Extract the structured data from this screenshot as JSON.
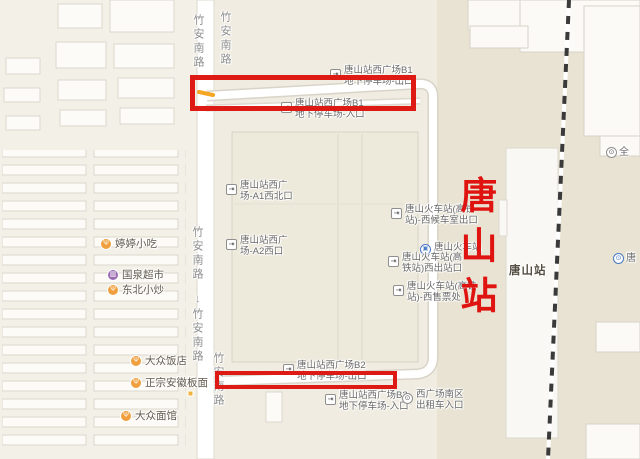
{
  "map": {
    "road_label": "竹安南路",
    "oneway_arrow": "↓",
    "station_overlay": "唐山站",
    "station_map_label": "唐山站",
    "highlight_color": "#dd1b14",
    "overlay_red": "#df1410",
    "labels": {
      "b1_exit": {
        "line1": "唐山站西广场B1",
        "line2": "地下停车场-出口",
        "icon": "gate-exit-icon"
      },
      "b1_entrance": {
        "line1": "唐山站西广场B1",
        "line2": "地下停车场-入口",
        "icon": "gate-entrance-icon"
      },
      "a1_gate": {
        "line1": "唐山站西广",
        "line2": "场-A1西北口",
        "icon": "gate-exit-icon"
      },
      "a2_gate": {
        "line1": "唐山站西广",
        "line2": "场-A2西口",
        "icon": "gate-exit-icon"
      },
      "west_waiting": {
        "line1": "唐山火车站(高铁",
        "line2": "站)-西候车室出口",
        "icon": "gate-exit-icon"
      },
      "railway_poi": {
        "label": "唐山火车站",
        "icon": "train-station-icon"
      },
      "west_exit": {
        "line1": "唐山火车站(高",
        "line2": "铁站)西出站口",
        "icon": "gate-exit-icon"
      },
      "ticket_office": {
        "line1": "唐山火车站(高铁",
        "line2": "站)-西售票处",
        "icon": "gate-exit-icon"
      },
      "b2_exit": {
        "line1": "唐山站西广场B2",
        "line2": "地下停车场-出口",
        "icon": "gate-exit-icon"
      },
      "b2_entrance": {
        "line1": "唐山站西广场B2",
        "line2": "地下停车场-入口",
        "icon": "gate-entrance-icon"
      },
      "taxi_entrance": {
        "line1": "西广场南区",
        "line2": "出租车入口",
        "icon": "taxi-icon"
      },
      "edge_top": {
        "label": "全",
        "icon": "poi-circle-icon"
      },
      "edge_bottom": {
        "label": "唐",
        "icon": "hotel-circle-icon"
      }
    },
    "pois": [
      {
        "name": "婷婷小吃",
        "category": "restaurant",
        "icon": "restaurant-icon"
      },
      {
        "name": "国泉超市",
        "category": "market",
        "icon": "supermarket-icon"
      },
      {
        "name": "东北小炒",
        "category": "restaurant",
        "icon": "restaurant-icon"
      },
      {
        "name": "大众饭店",
        "category": "restaurant",
        "icon": "restaurant-icon"
      },
      {
        "name": "正宗安徽板面",
        "category": "restaurant",
        "icon": "restaurant-icon"
      },
      {
        "name": "大众面馆",
        "category": "restaurant",
        "icon": "restaurant-icon"
      }
    ]
  }
}
